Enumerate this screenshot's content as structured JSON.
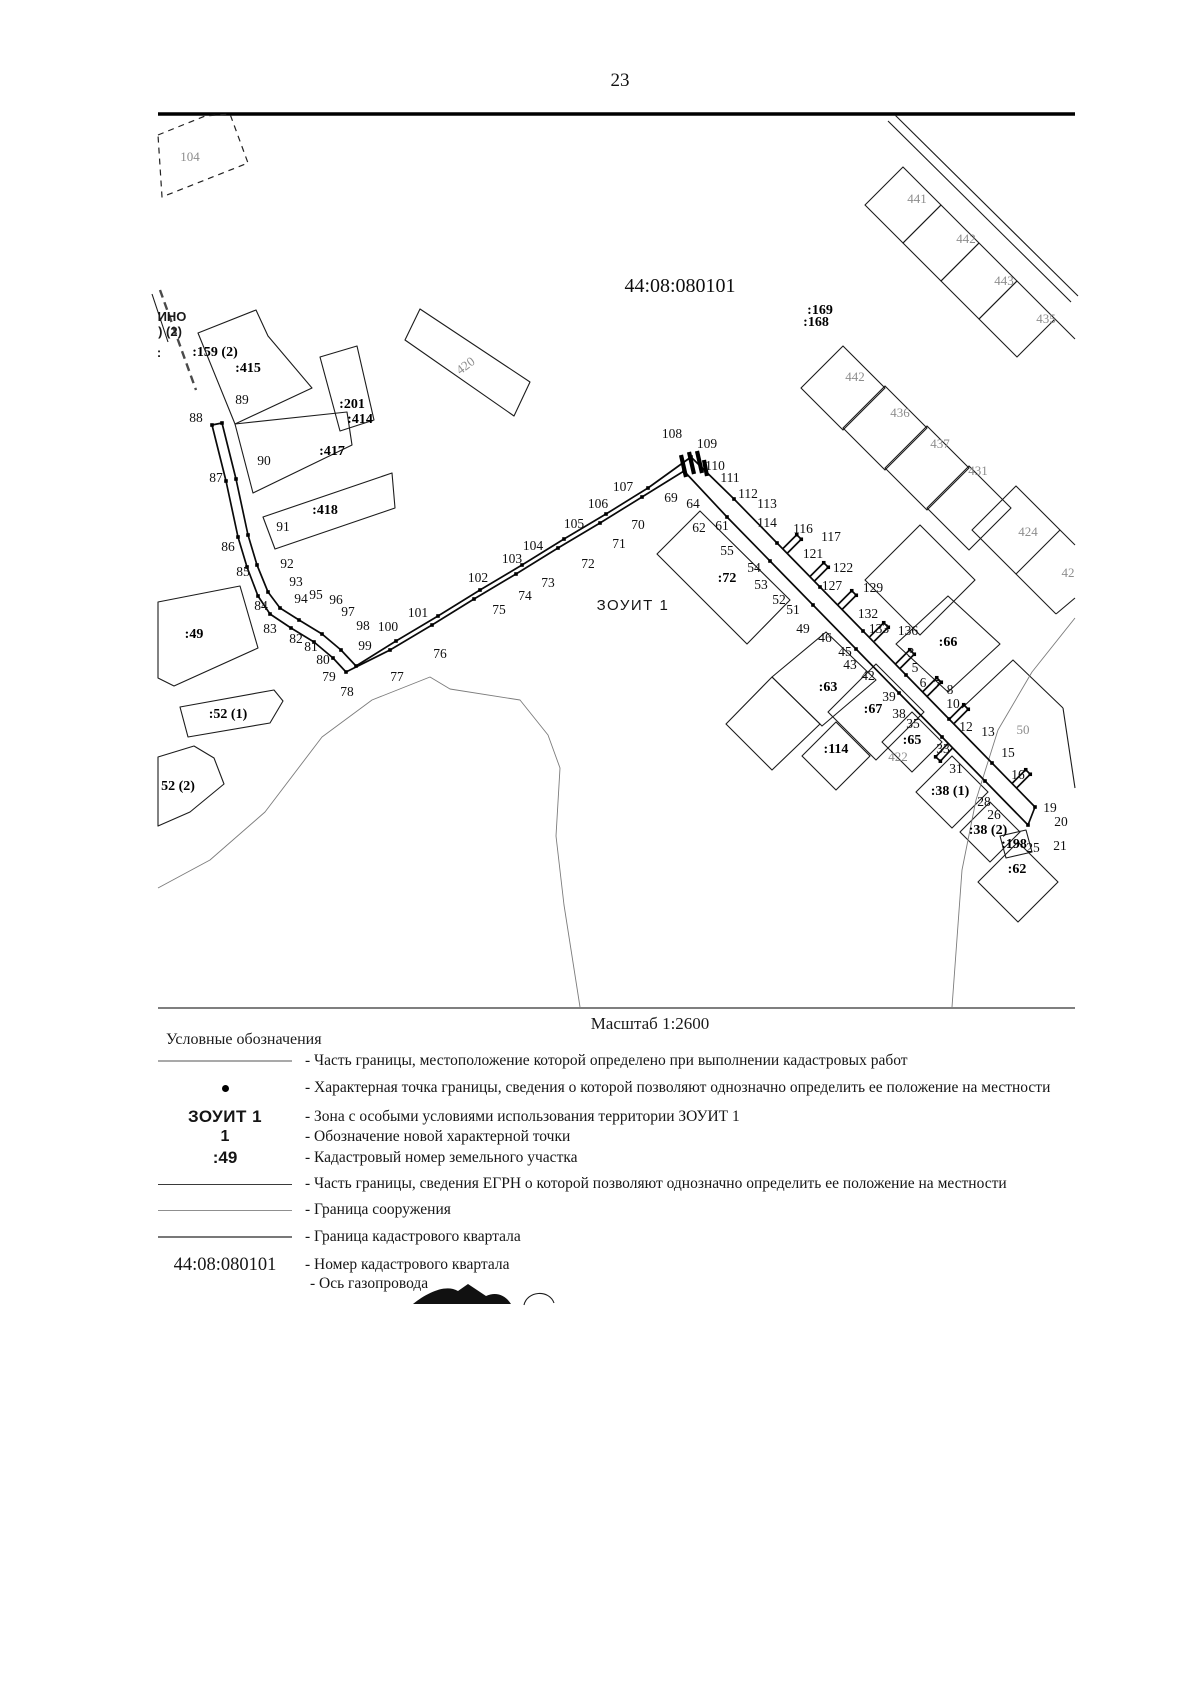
{
  "page": {
    "number": "23"
  },
  "map": {
    "scale_label": "Масштаб 1:2600",
    "quarter_number": "44:08:080101",
    "zone_label": "ЗОУИТ 1",
    "pipe": {
      "outer": "212,425 226,481 238,537 247,567 258,596 270,614 291,628 314,642 333,658 346,672 390,650 432,625 474,599 516,574 558,548 600,523 642,497 684,471 727,517 770,561 813,605 856,649 899,693 942,737 985,781 1028,825",
      "inner": "222,423 236,479 248,535 257,565 268,592 280,608 299,620 322,634 341,650 356,666 396,641 438,616 480,590 522,565 564,539 606,514 648,488 691,457 734,499 777,543 820,587 863,631 906,675 949,719 992,763 1035,807",
      "caps": [
        [
          212,
          425,
          222,
          423
        ],
        [
          1028,
          825,
          1035,
          807
        ]
      ],
      "stubs": [
        [
          785,
          551,
          799,
          537
        ],
        [
          812,
          579,
          826,
          565
        ],
        [
          840,
          607,
          854,
          593
        ],
        [
          872,
          639,
          886,
          625
        ],
        [
          898,
          666,
          912,
          652
        ],
        [
          925,
          694,
          939,
          680
        ],
        [
          952,
          721,
          966,
          707
        ],
        [
          950,
          746,
          938,
          759
        ],
        [
          1014,
          786,
          1028,
          772
        ]
      ],
      "thick": [
        [
          681,
          455,
          686,
          477
        ],
        [
          689,
          452,
          694,
          474
        ],
        [
          697,
          451,
          702,
          473
        ],
        [
          704,
          460,
          707,
          476
        ]
      ]
    },
    "lines": [
      {
        "n": "top-rule",
        "p": "158,114 1075,114",
        "c": "rule-top"
      },
      {
        "n": "bottom-rule",
        "p": "158,1008 1075,1008",
        "c": "rule-bot"
      },
      {
        "n": "road-line",
        "p": "895,115 1078,296",
        "c": "thin"
      },
      {
        "n": "road-line",
        "p": "888,121 1071,302",
        "c": "thin"
      },
      {
        "n": "parcel-441",
        "p": "903,167 941,205 903,243 865,205",
        "c": "thin",
        "closed": true
      },
      {
        "n": "parcel-442",
        "p": "941,205 979,243 941,281 903,243",
        "c": "thin",
        "closed": true
      },
      {
        "n": "parcel-443",
        "p": "979,243 1017,281 979,319 941,281",
        "c": "thin",
        "closed": true
      },
      {
        "n": "parcel-435",
        "p": "1017,281 1055,319 1017,357 979,319",
        "c": "thin",
        "closed": true
      },
      {
        "n": "parcel-442b",
        "p": "843,346 885,388 843,430 801,388",
        "c": "thin",
        "closed": true
      },
      {
        "n": "parcel-436",
        "p": "885,386 927,428 885,470 843,428",
        "c": "thin",
        "closed": true
      },
      {
        "n": "parcel-437",
        "p": "927,426 969,468 927,510 885,468",
        "c": "thin",
        "closed": true
      },
      {
        "n": "parcel-431",
        "p": "969,466 1011,508 969,550 927,508",
        "c": "thin",
        "closed": true
      },
      {
        "n": "parcel-424",
        "p": "1016,486 1060,530 1016,574 972,530",
        "c": "thin",
        "closed": true
      },
      {
        "n": "parcel-edge",
        "p": "1060,530 1075,545",
        "c": "thin"
      },
      {
        "n": "parcel-edge",
        "p": "1016,574 1056,614",
        "c": "thin"
      },
      {
        "n": "parcel-edge",
        "p": "1056,614 1075,598",
        "c": "thin"
      },
      {
        "n": "parcel-edge",
        "p": "1055,319 1075,339",
        "c": "thin"
      },
      {
        "n": "parcel-104",
        "p": "158,135 205,116 230,114 248,163 162,197",
        "c": "dashthin",
        "closed": true
      },
      {
        "n": "quarter-band",
        "p": "160,290 178,340 196,390",
        "c": "dashb"
      },
      {
        "n": "quarter-band",
        "p": "152,294 168,342",
        "c": "thin"
      },
      {
        "n": "parcel-415",
        "p": "198,333 256,310 268,336 312,388 235,424",
        "c": "thin",
        "closed": true
      },
      {
        "n": "parcel-417",
        "p": "235,424 347,412 352,445 253,493",
        "c": "thin",
        "closed": true
      },
      {
        "n": "parcel-201",
        "p": "320,357 357,346 374,420 340,431",
        "c": "thin",
        "closed": true
      },
      {
        "n": "parcel-418",
        "p": "263,517 392,473 395,508 275,549",
        "c": "thin",
        "closed": true
      },
      {
        "n": "parcel-420",
        "p": "405,340 420,309 530,382 514,416",
        "c": "thin",
        "closed": true
      },
      {
        "n": "parcel-49",
        "p": "158,602 240,586 258,648 174,686 158,678",
        "c": "thin",
        "closed": true
      },
      {
        "n": "parcel-52-1",
        "p": "180,707 274,690 283,701 270,723 188,737",
        "c": "thin",
        "closed": true
      },
      {
        "n": "parcel-52-2",
        "p": "158,757 194,746 214,758 224,784 190,812 158,826",
        "c": "thin",
        "closed": true
      },
      {
        "n": "parcel-72",
        "p": "657,554 700,511 790,600 747,644",
        "c": "thin",
        "closed": true
      },
      {
        "n": "parcel-63",
        "p": "772,677 826,632 876,680 822,726",
        "c": "thin",
        "closed": true
      },
      {
        "n": "parcel-67",
        "p": "876,664 924,712 876,760 828,712",
        "c": "thin",
        "closed": true
      },
      {
        "n": "parcel-unlabeled",
        "p": "726,724 772,677 820,724 772,770",
        "c": "thin",
        "closed": true
      },
      {
        "n": "parcel-114",
        "p": "836,722 870,756 836,790 802,756",
        "c": "thin",
        "closed": true
      },
      {
        "n": "parcel-65",
        "p": "912,712 942,742 912,772 882,742",
        "c": "thin",
        "closed": true
      },
      {
        "n": "parcel-38-1",
        "p": "952,756 988,792 952,828 916,792",
        "c": "thin",
        "closed": true
      },
      {
        "n": "parcel-38-2",
        "p": "990,802 1020,832 990,862 960,832",
        "c": "thin",
        "closed": true
      },
      {
        "n": "parcel-198",
        "p": "1000,836 1026,830 1032,852 1006,858",
        "c": "thin",
        "closed": true
      },
      {
        "n": "parcel-62",
        "p": "1018,842 1058,882 1018,922 978,882",
        "c": "thin",
        "closed": true
      },
      {
        "n": "parcel-66",
        "p": "948,596 1000,644 948,692 896,644",
        "c": "thin",
        "closed": true
      },
      {
        "n": "parcel-unlabeled",
        "p": "920,525 975,580 920,635 865,580",
        "c": "thin",
        "closed": true
      },
      {
        "n": "parcel-50-edge",
        "p": "962,708 1013,660 1063,708",
        "c": "thin"
      },
      {
        "n": "parcel-50-edge",
        "p": "1063,708 1075,788",
        "c": "thin"
      },
      {
        "n": "quarter-curve",
        "p": "1075,618 1032,672 998,730 976,800 962,870 952,1007",
        "c": "curve"
      },
      {
        "n": "quarter-curve",
        "p": "158,888 210,860 265,812 322,737 372,700 430,677 450,689 520,700 548,735 560,768 556,836 564,905 580,1007",
        "c": "curve"
      }
    ],
    "labels": [
      {
        "t": "44:08:080101",
        "x": 680,
        "y": 287,
        "c": "big"
      },
      {
        "t": "ЗОУИТ 1",
        "x": 633,
        "y": 605,
        "c": "zone"
      },
      {
        "t": "ИНО",
        "x": 172,
        "y": 316,
        "c": "edge"
      },
      {
        "t": ") (2)",
        "x": 170,
        "y": 331,
        "c": "edge"
      },
      {
        "t": ":",
        "x": 159,
        "y": 352,
        "c": "edge"
      },
      {
        "t": ":169",
        "x": 820,
        "y": 309,
        "c": "bold"
      },
      {
        "t": ":168",
        "x": 816,
        "y": 321,
        "c": "bold"
      },
      {
        "t": ":159 (2)",
        "x": 215,
        "y": 351,
        "c": "bold"
      },
      {
        "t": ":415",
        "x": 248,
        "y": 367,
        "c": "bold"
      },
      {
        "t": ":201",
        "x": 352,
        "y": 403,
        "c": "bold"
      },
      {
        "t": ":414",
        "x": 360,
        "y": 418,
        "c": "bold"
      },
      {
        "t": ":417",
        "x": 332,
        "y": 450,
        "c": "bold"
      },
      {
        "t": ":418",
        "x": 325,
        "y": 509,
        "c": "bold"
      },
      {
        "t": ":49",
        "x": 194,
        "y": 633,
        "c": "bold"
      },
      {
        "t": ":52 (1)",
        "x": 228,
        "y": 713,
        "c": "bold"
      },
      {
        "t": "52 (2)",
        "x": 178,
        "y": 785,
        "c": "bold"
      },
      {
        "t": ":72",
        "x": 727,
        "y": 577,
        "c": "bold"
      },
      {
        "t": ":63",
        "x": 828,
        "y": 686,
        "c": "bold"
      },
      {
        "t": ":67",
        "x": 873,
        "y": 708,
        "c": "bold"
      },
      {
        "t": ":65",
        "x": 912,
        "y": 739,
        "c": "bold"
      },
      {
        "t": ":114",
        "x": 836,
        "y": 748,
        "c": "bold"
      },
      {
        "t": ":38 (1)",
        "x": 950,
        "y": 790,
        "c": "bold"
      },
      {
        "t": ":38 (2)",
        "x": 988,
        "y": 829,
        "c": "bold"
      },
      {
        "t": ":198",
        "x": 1014,
        "y": 843,
        "c": "bold"
      },
      {
        "t": ":62",
        "x": 1017,
        "y": 868,
        "c": "bold"
      },
      {
        "t": ":66",
        "x": 948,
        "y": 641,
        "c": "bold"
      },
      {
        "t": "104",
        "x": 190,
        "y": 156,
        "c": "faint"
      },
      {
        "t": "420",
        "x": 465,
        "y": 365,
        "c": "faint",
        "r": -37
      },
      {
        "t": "441",
        "x": 917,
        "y": 198,
        "c": "faint"
      },
      {
        "t": "442",
        "x": 966,
        "y": 238,
        "c": "faint"
      },
      {
        "t": "443",
        "x": 1004,
        "y": 280,
        "c": "faint"
      },
      {
        "t": "435",
        "x": 1046,
        "y": 318,
        "c": "faint"
      },
      {
        "t": "442",
        "x": 855,
        "y": 376,
        "c": "faint"
      },
      {
        "t": "436",
        "x": 900,
        "y": 412,
        "c": "faint"
      },
      {
        "t": "437",
        "x": 940,
        "y": 443,
        "c": "faint"
      },
      {
        "t": "431",
        "x": 978,
        "y": 470,
        "c": "faint"
      },
      {
        "t": "424",
        "x": 1028,
        "y": 531,
        "c": "faint"
      },
      {
        "t": "42",
        "x": 1068,
        "y": 572,
        "c": "faint"
      },
      {
        "t": "422",
        "x": 898,
        "y": 756,
        "c": "faint"
      },
      {
        "t": "50",
        "x": 1023,
        "y": 729,
        "c": "faint"
      },
      {
        "t": "88",
        "x": 196,
        "y": 417
      },
      {
        "t": "87",
        "x": 216,
        "y": 477
      },
      {
        "t": "86",
        "x": 228,
        "y": 546
      },
      {
        "t": "85",
        "x": 243,
        "y": 571
      },
      {
        "t": "84",
        "x": 261,
        "y": 605
      },
      {
        "t": "83",
        "x": 270,
        "y": 628
      },
      {
        "t": "82",
        "x": 296,
        "y": 638
      },
      {
        "t": "81",
        "x": 311,
        "y": 646
      },
      {
        "t": "80",
        "x": 323,
        "y": 659
      },
      {
        "t": "79",
        "x": 329,
        "y": 676
      },
      {
        "t": "78",
        "x": 347,
        "y": 691
      },
      {
        "t": "89",
        "x": 242,
        "y": 399
      },
      {
        "t": "90",
        "x": 264,
        "y": 460
      },
      {
        "t": "91",
        "x": 283,
        "y": 526
      },
      {
        "t": "92",
        "x": 287,
        "y": 563
      },
      {
        "t": "93",
        "x": 296,
        "y": 581
      },
      {
        "t": "94",
        "x": 301,
        "y": 598
      },
      {
        "t": "95",
        "x": 316,
        "y": 594
      },
      {
        "t": "96",
        "x": 336,
        "y": 599
      },
      {
        "t": "97",
        "x": 348,
        "y": 611
      },
      {
        "t": "98",
        "x": 363,
        "y": 625
      },
      {
        "t": "99",
        "x": 365,
        "y": 645
      },
      {
        "t": "100",
        "x": 388,
        "y": 626
      },
      {
        "t": "101",
        "x": 418,
        "y": 612
      },
      {
        "t": "77",
        "x": 397,
        "y": 676
      },
      {
        "t": "76",
        "x": 440,
        "y": 653
      },
      {
        "t": "75",
        "x": 499,
        "y": 609
      },
      {
        "t": "74",
        "x": 525,
        "y": 595
      },
      {
        "t": "73",
        "x": 548,
        "y": 582
      },
      {
        "t": "72",
        "x": 588,
        "y": 563
      },
      {
        "t": "71",
        "x": 619,
        "y": 543
      },
      {
        "t": "70",
        "x": 638,
        "y": 524
      },
      {
        "t": "69",
        "x": 671,
        "y": 497
      },
      {
        "t": "102",
        "x": 478,
        "y": 577
      },
      {
        "t": "103",
        "x": 512,
        "y": 558
      },
      {
        "t": "104",
        "x": 533,
        "y": 545
      },
      {
        "t": "105",
        "x": 574,
        "y": 523
      },
      {
        "t": "106",
        "x": 598,
        "y": 503
      },
      {
        "t": "107",
        "x": 623,
        "y": 486
      },
      {
        "t": "108",
        "x": 672,
        "y": 433
      },
      {
        "t": "109",
        "x": 707,
        "y": 443
      },
      {
        "t": "110",
        "x": 715,
        "y": 465
      },
      {
        "t": "111",
        "x": 730,
        "y": 477
      },
      {
        "t": "112",
        "x": 748,
        "y": 493
      },
      {
        "t": "113",
        "x": 767,
        "y": 503
      },
      {
        "t": "114",
        "x": 767,
        "y": 522
      },
      {
        "t": "116",
        "x": 803,
        "y": 528
      },
      {
        "t": "117",
        "x": 831,
        "y": 536
      },
      {
        "t": "121",
        "x": 813,
        "y": 553
      },
      {
        "t": "122",
        "x": 843,
        "y": 567
      },
      {
        "t": "127",
        "x": 832,
        "y": 585
      },
      {
        "t": "129",
        "x": 873,
        "y": 587
      },
      {
        "t": "132",
        "x": 868,
        "y": 613
      },
      {
        "t": "133",
        "x": 879,
        "y": 628
      },
      {
        "t": "136",
        "x": 908,
        "y": 630
      },
      {
        "t": "64",
        "x": 693,
        "y": 503
      },
      {
        "t": "62",
        "x": 699,
        "y": 527
      },
      {
        "t": "61",
        "x": 722,
        "y": 525
      },
      {
        "t": "55",
        "x": 727,
        "y": 550
      },
      {
        "t": "54",
        "x": 754,
        "y": 567
      },
      {
        "t": "53",
        "x": 761,
        "y": 584
      },
      {
        "t": "52",
        "x": 779,
        "y": 599
      },
      {
        "t": "51",
        "x": 793,
        "y": 609
      },
      {
        "t": "49",
        "x": 803,
        "y": 628
      },
      {
        "t": "46",
        "x": 825,
        "y": 637
      },
      {
        "t": "45",
        "x": 845,
        "y": 651
      },
      {
        "t": "43",
        "x": 850,
        "y": 664
      },
      {
        "t": "42",
        "x": 868,
        "y": 675
      },
      {
        "t": "39",
        "x": 889,
        "y": 696
      },
      {
        "t": "38",
        "x": 899,
        "y": 713
      },
      {
        "t": "35",
        "x": 913,
        "y": 723
      },
      {
        "t": "33",
        "x": 943,
        "y": 748
      },
      {
        "t": "31",
        "x": 956,
        "y": 768
      },
      {
        "t": "28",
        "x": 984,
        "y": 801
      },
      {
        "t": "26",
        "x": 994,
        "y": 814
      },
      {
        "t": "3",
        "x": 911,
        "y": 652
      },
      {
        "t": "5",
        "x": 915,
        "y": 667
      },
      {
        "t": "6",
        "x": 923,
        "y": 682
      },
      {
        "t": "7",
        "x": 937,
        "y": 684
      },
      {
        "t": "8",
        "x": 950,
        "y": 689
      },
      {
        "t": "10",
        "x": 953,
        "y": 703
      },
      {
        "t": "12",
        "x": 966,
        "y": 726
      },
      {
        "t": "13",
        "x": 988,
        "y": 731
      },
      {
        "t": "15",
        "x": 1008,
        "y": 752
      },
      {
        "t": "16",
        "x": 1018,
        "y": 774
      },
      {
        "t": "19",
        "x": 1050,
        "y": 807
      },
      {
        "t": "20",
        "x": 1061,
        "y": 821
      },
      {
        "t": "21",
        "x": 1060,
        "y": 845
      },
      {
        "t": "25",
        "x": 1033,
        "y": 847
      }
    ]
  },
  "legend": {
    "title": "Условные обозначения",
    "rows": [
      {
        "sym": "line-gray",
        "text": "- Часть границы, местоположение которой определено при выполнении кадастровых работ"
      },
      {
        "sym": "dot",
        "text": "- Характерная точка границы, сведения о которой позволяют однозначно определить ее положение на местности"
      },
      {
        "sym": "text-zone",
        "symText": "ЗОУИТ 1",
        "text": "- Зона с особыми условиями использования территории ЗОУИТ 1"
      },
      {
        "sym": "text-new-pt",
        "symText": "1",
        "text": "- Обозначение новой характерной точки"
      },
      {
        "sym": "text-cad",
        "symText": ":49",
        "text": "- Кадастровый номер земельного участка"
      },
      {
        "sym": "line-dark",
        "text": "- Часть границы, сведения ЕГРН о которой позволяют однозначно определить ее положение на местности"
      },
      {
        "sym": "line-mid",
        "text": "- Граница сооружения"
      },
      {
        "sym": "line-quarter",
        "text": "- Граница кадастрового квартала"
      },
      {
        "sym": "text-serif",
        "symText": "44:08:080101",
        "text": "- Номер кадастрового квартала"
      },
      {
        "sym": "none",
        "text": "- Ось газопровода"
      }
    ]
  }
}
